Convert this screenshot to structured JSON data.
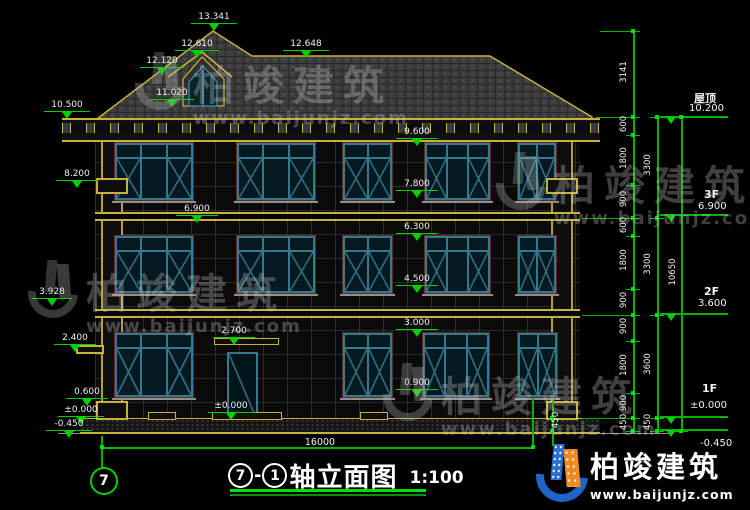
{
  "drawing": {
    "title": {
      "axis_start": "7",
      "axis_end": "1",
      "dash": "-",
      "name": "轴立面图",
      "scale": "1:100"
    },
    "axis_bubble": "7",
    "total_width": "16000",
    "levels": {
      "peak": "13.341",
      "dormer_ridge": "12.610",
      "roof_left": "12.120",
      "dormer_base": "11.020",
      "eave": "10.500",
      "ridge": "12.648",
      "capital": "8.200",
      "floor3_left": "6.900",
      "w3_head": "9.600",
      "w3_sill": "7.800",
      "w2_head": "6.300",
      "w2_sill": "4.500",
      "w1_head": "3.000",
      "w1_sill": "0.900",
      "porch": "2.700",
      "door_zero": "±0.000",
      "left_landing": "3.928",
      "left_ledge": "2.400",
      "left_plinth": "0.600",
      "left_zero": "±0.000",
      "left_minus": "-0.450"
    },
    "right": {
      "seg_small": [
        "3141",
        "600",
        "1800",
        "900",
        "600",
        "1800",
        "900",
        "900",
        "1800",
        "900",
        "450"
      ],
      "seg_floor": [
        "3300",
        "3300",
        "3600",
        "450"
      ],
      "total_height": "10650",
      "edge_step": "450",
      "markers": [
        {
          "name": "屋顶",
          "elev": "10.200"
        },
        {
          "name": "3F",
          "elev": "6.900"
        },
        {
          "name": "2F",
          "elev": "3.600"
        },
        {
          "name": "1F",
          "elev": "±0.000"
        },
        {
          "name": "",
          "elev": "-0.450"
        }
      ]
    },
    "watermark": {
      "brand": "柏竣建筑",
      "url": "www.baijunjz.com"
    },
    "logo": {
      "brand": "柏竣建筑",
      "url": "www.baijunjz.com"
    }
  }
}
